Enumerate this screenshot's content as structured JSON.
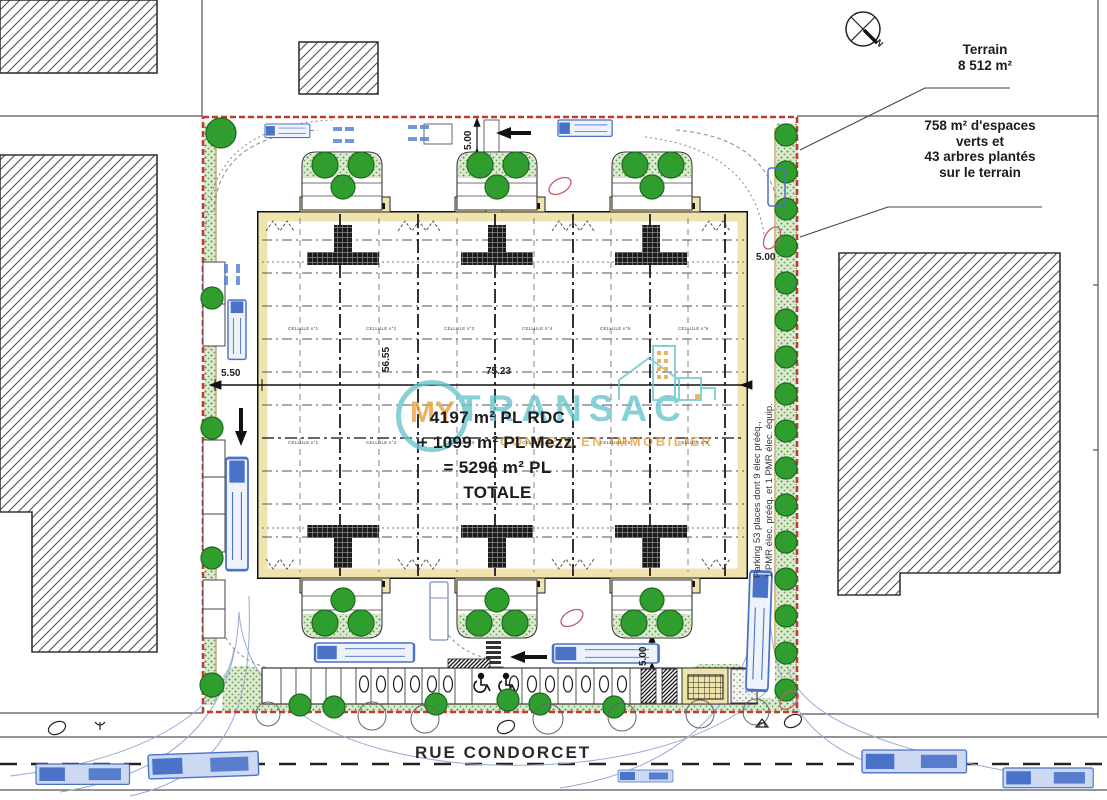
{
  "annotations": {
    "terrain_line1": "Terrain",
    "terrain_line2": "8 512 m²",
    "green_line1": "758 m² d'espaces",
    "green_line2": "verts et",
    "green_line3": "43 arbres plantés",
    "green_line4": "sur le terrain",
    "compass": "N"
  },
  "building": {
    "area_line1": "4197 m² PL RDC",
    "area_line2": "+ 1099 m² PL Mezz.",
    "area_line3": "= 5296 m² PL",
    "area_line4": "TOTALE",
    "cells": [
      "CELLULE n°1",
      "CELLULE n°2",
      "CELLULE n°3",
      "CELLULE n°4",
      "CELLULE n°5",
      "CELLULE n°6"
    ]
  },
  "dimensions": {
    "top_aisle": "5.00",
    "right_aisle": "5.00",
    "bottom_aisle": "5.00",
    "left_strip": "5.50",
    "building_width": "75.23",
    "building_depth": "56.55"
  },
  "parking_note": {
    "line1": "Parking 53 places dont 9 élec prééq.,",
    "line2": "1 PMR élec. prééq. et 1 PMR élec. équip."
  },
  "street": {
    "name": "RUE CONDORCET"
  },
  "watermark": {
    "prefix": "MY",
    "name": "TRANSAC",
    "tagline": "CONSEIL EN IMMOBILIER",
    "teal": "#6ac5ce",
    "orange": "#e8a23c"
  },
  "colors": {
    "boundary": "#c23b2e",
    "tree": "#2f9e2f",
    "hedge": "#dcead0",
    "wall": "#f0e4ae",
    "vehicle": "#4a72c8",
    "turning_path": "#97abd6"
  }
}
